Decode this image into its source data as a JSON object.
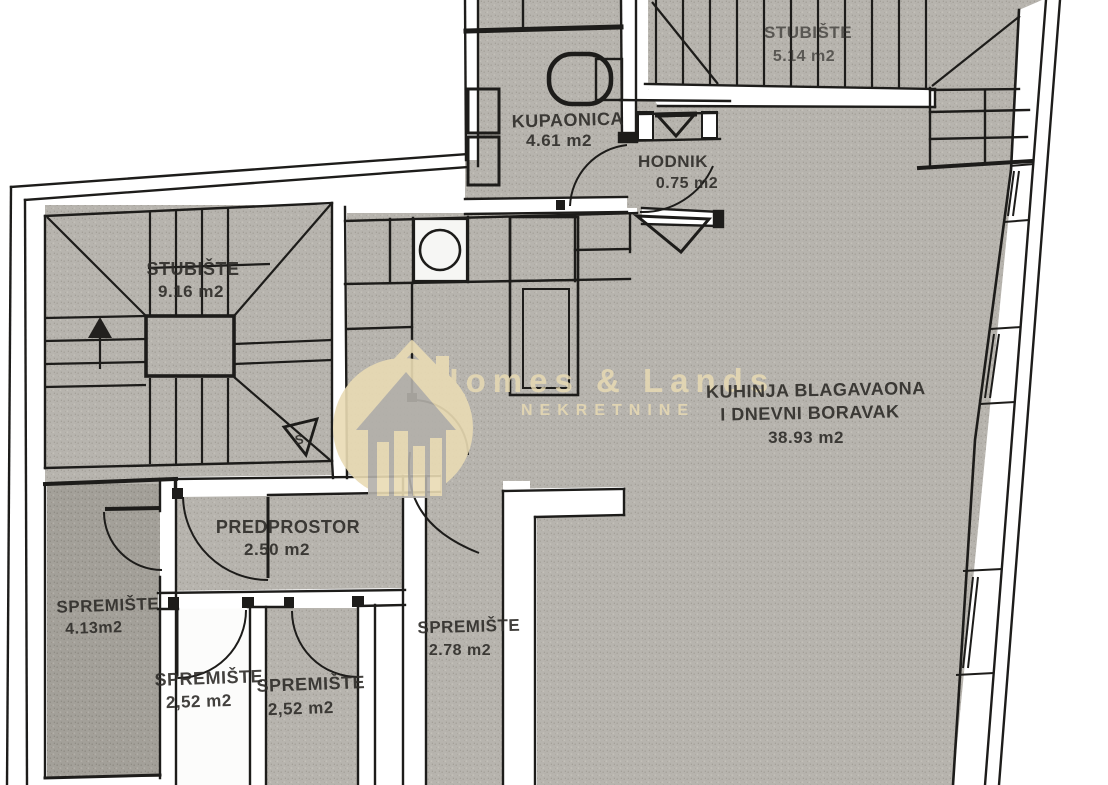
{
  "watermark": {
    "brand": "Homes & Lands",
    "tagline": "NEKRETNINE",
    "color": "#e9dbb4"
  },
  "rooms": {
    "stubiste_top": {
      "name": "STUBIŠTE",
      "area": "5.14 m2"
    },
    "kupaonica": {
      "name": "KUPAONICA",
      "area": "4.61 m2"
    },
    "hodnik": {
      "name": "HODNIK",
      "area": "0.75 m2"
    },
    "stubiste_left": {
      "name": "STUBIŠTE",
      "area": "9.16 m2"
    },
    "kuhinja": {
      "line1": "KUHINJA BLAGAVAONA",
      "line2": "I DNEVNI BORAVAK",
      "area": "38.93 m2"
    },
    "predprostor": {
      "name": "PREDPROSTOR",
      "area": "2.50 m2"
    },
    "spremiste_a": {
      "name": "SPREMIŠTE",
      "area": "4.13m2"
    },
    "spremiste_b": {
      "name": "SPREMIŠTE",
      "area": "2.78 m2"
    },
    "spremiste_c": {
      "name": "SPREMIŠTE",
      "area": "2,52 m2"
    },
    "spremiste_d": {
      "name": "SPREMIŠTE",
      "area": "2,52 m2"
    }
  },
  "markers": {
    "stair_direction": "S"
  },
  "colors": {
    "floor": "#b7b4ae",
    "floor_dark": "#a3a099",
    "wall_line": "#1d1c1a",
    "watermark": "#e9dbb4"
  }
}
